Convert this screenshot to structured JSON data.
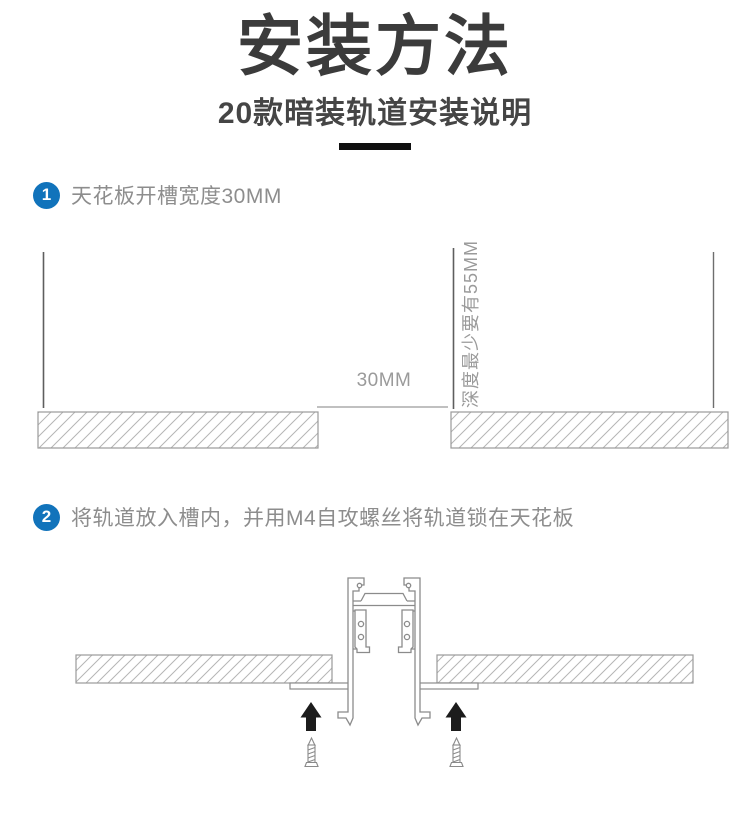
{
  "header": {
    "title": "安装方法",
    "subtitle": "20款暗装轨道安装说明"
  },
  "steps": [
    {
      "number": "1",
      "label": "天花板开槽宽度30MM"
    },
    {
      "number": "2",
      "label": "将轨道放入槽内，并用M4自攻螺丝将轨道锁在天花板"
    }
  ],
  "diagram1": {
    "slot_width_label": "30MM",
    "depth_label": "深度最少要有55MM"
  },
  "icons": {
    "step_badge": "blue-circle-number",
    "up_arrow": "solid-black-up-arrow",
    "screw": "self-tapping-screw-pointing-up"
  },
  "colors": {
    "badge_blue": "#1173bb",
    "title_text": "#3b3b3b",
    "subtitle_text": "#454545",
    "step_text": "#8d8d8d",
    "dimension_label": "#9a9a9a",
    "guide_line": "#5e5e5e",
    "profile_outline": "#8b8b8b",
    "hatch_line": "#b5b5b5",
    "arrow_black": "#1c1c1c",
    "divider_black": "#101010"
  }
}
